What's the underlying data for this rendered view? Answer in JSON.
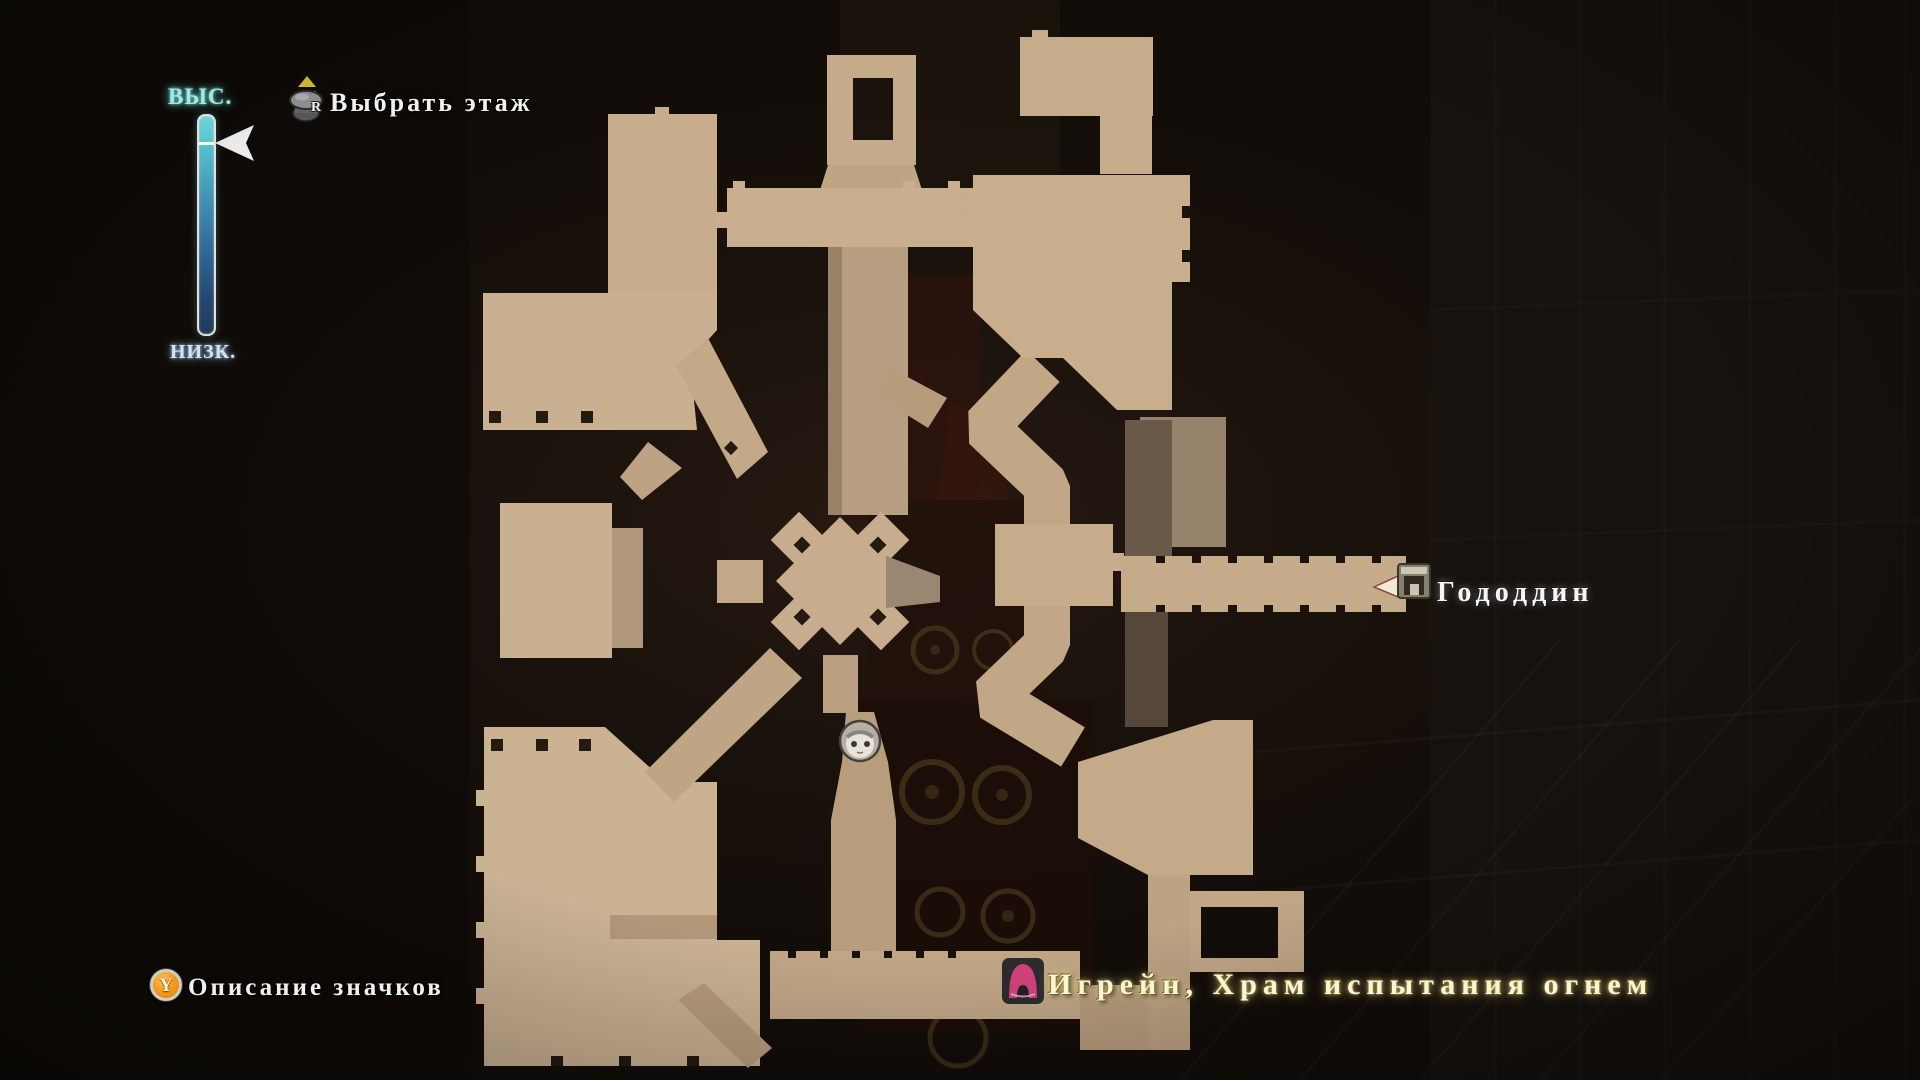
{
  "map_screen": {
    "elevation_gauge": {
      "high": "ВЫС.",
      "low": "НИЗК."
    },
    "floor_select": {
      "button": "R",
      "label": "Выбрать этаж"
    },
    "legend_hint": {
      "button": "Y",
      "label": "Описание значков"
    },
    "marker": {
      "label": "Гододдин"
    },
    "location": {
      "label": "Игрейн, Храм испытания огнем"
    },
    "colors": {
      "high_label": "#9feae2",
      "low_label": "#d4e2f0",
      "gauge_top": "#6cd6da",
      "gauge_bottom": "#203a5c",
      "y_button_orange": "#f59c1e",
      "marker_icon_magenta": "#d6437f",
      "location_text_cream": "#faf4d0",
      "map_tan": "#c8ae8e",
      "background": "#110d09"
    }
  }
}
